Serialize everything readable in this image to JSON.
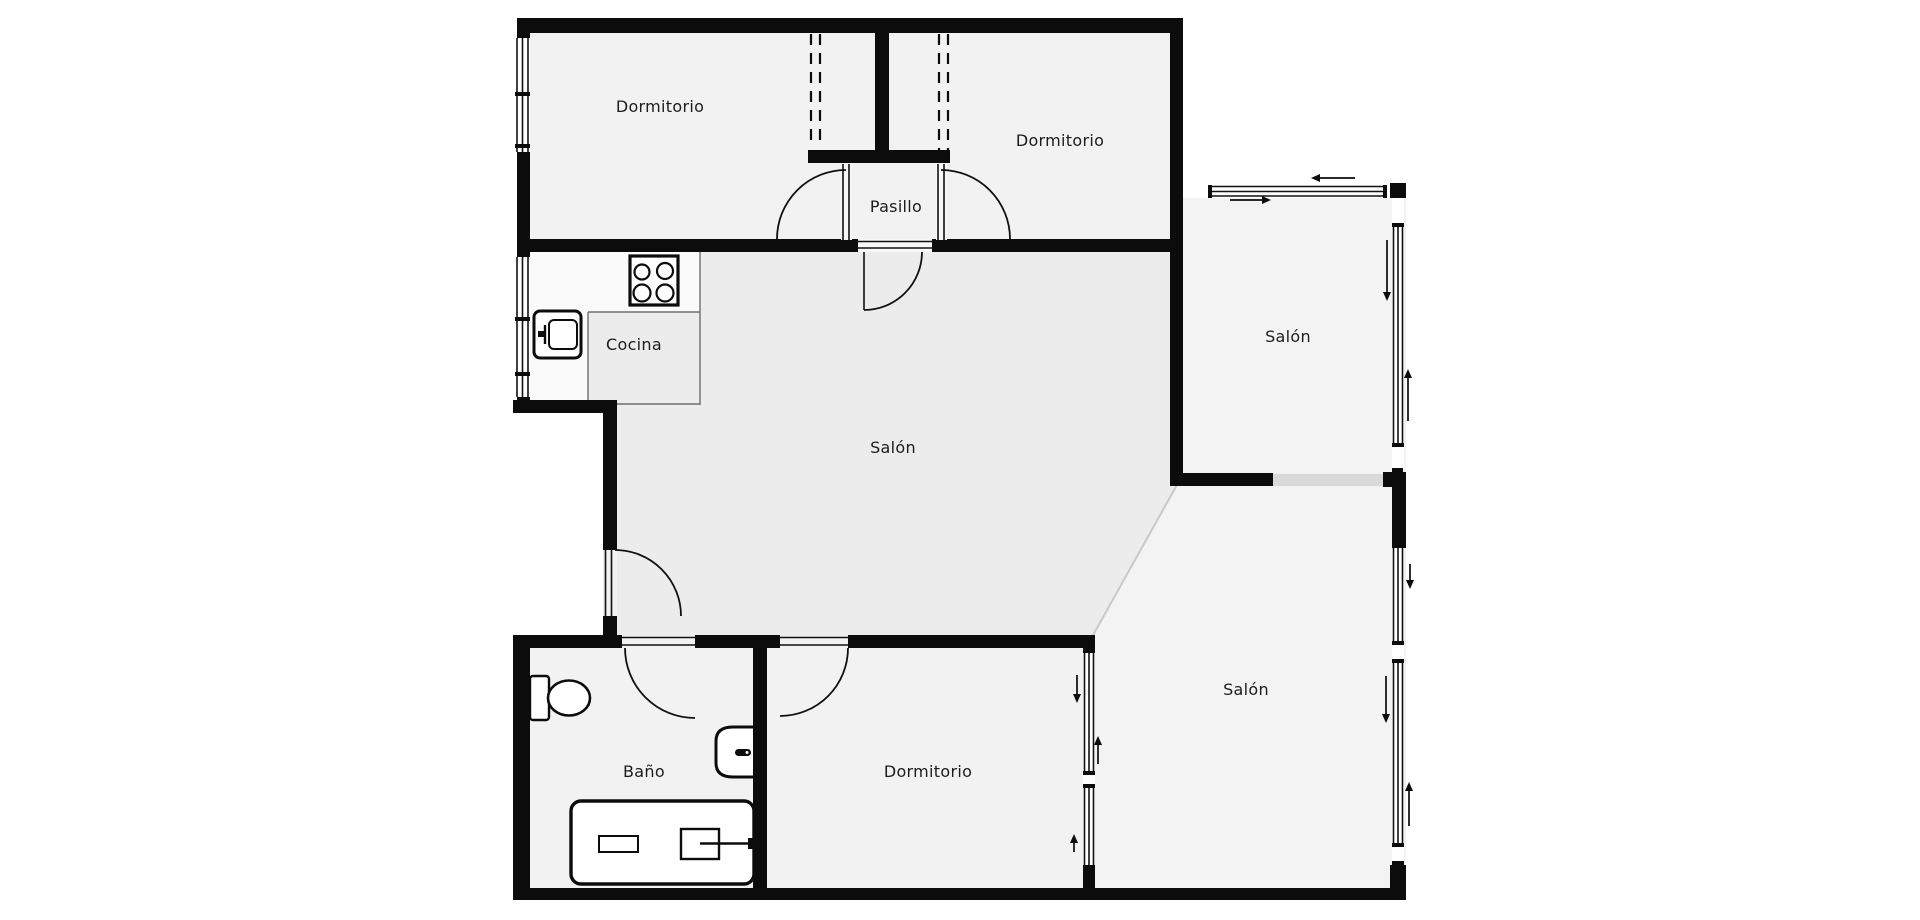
{
  "plan": {
    "type": "apartment-floor-plan",
    "rooms": {
      "dormitorio1": {
        "label": "Dormitorio"
      },
      "dormitorio2": {
        "label": "Dormitorio"
      },
      "dormitorio3": {
        "label": "Dormitorio"
      },
      "pasillo": {
        "label": "Pasillo"
      },
      "cocina": {
        "label": "Cocina"
      },
      "salon_main": {
        "label": "Salón"
      },
      "salon_upper": {
        "label": "Salón"
      },
      "salon_lower": {
        "label": "Salón"
      },
      "bano": {
        "label": "Baño"
      }
    },
    "icons": [
      "stove-icon",
      "washing-machine-icon",
      "toilet-icon",
      "sink-icon",
      "bathtub-icon",
      "shower-icon",
      "door-swing-arc",
      "window-glazing",
      "wardrobe-dashed-line",
      "slide-arrow"
    ],
    "slide_arrows": [
      "left",
      "right",
      "down",
      "up",
      "down",
      "down",
      "up",
      "down",
      "up",
      "up"
    ],
    "colors": {
      "background": "#ffffff",
      "wall": "#0c0c0c",
      "floor": "#f2f2f2",
      "salon_floor": "#ececec",
      "terrace_floor": "#f3f3f3",
      "counter": "#fafafa",
      "cocina_zone": "#ececec",
      "opening": "#d9d9d9",
      "text": "#1c1c1c"
    }
  }
}
